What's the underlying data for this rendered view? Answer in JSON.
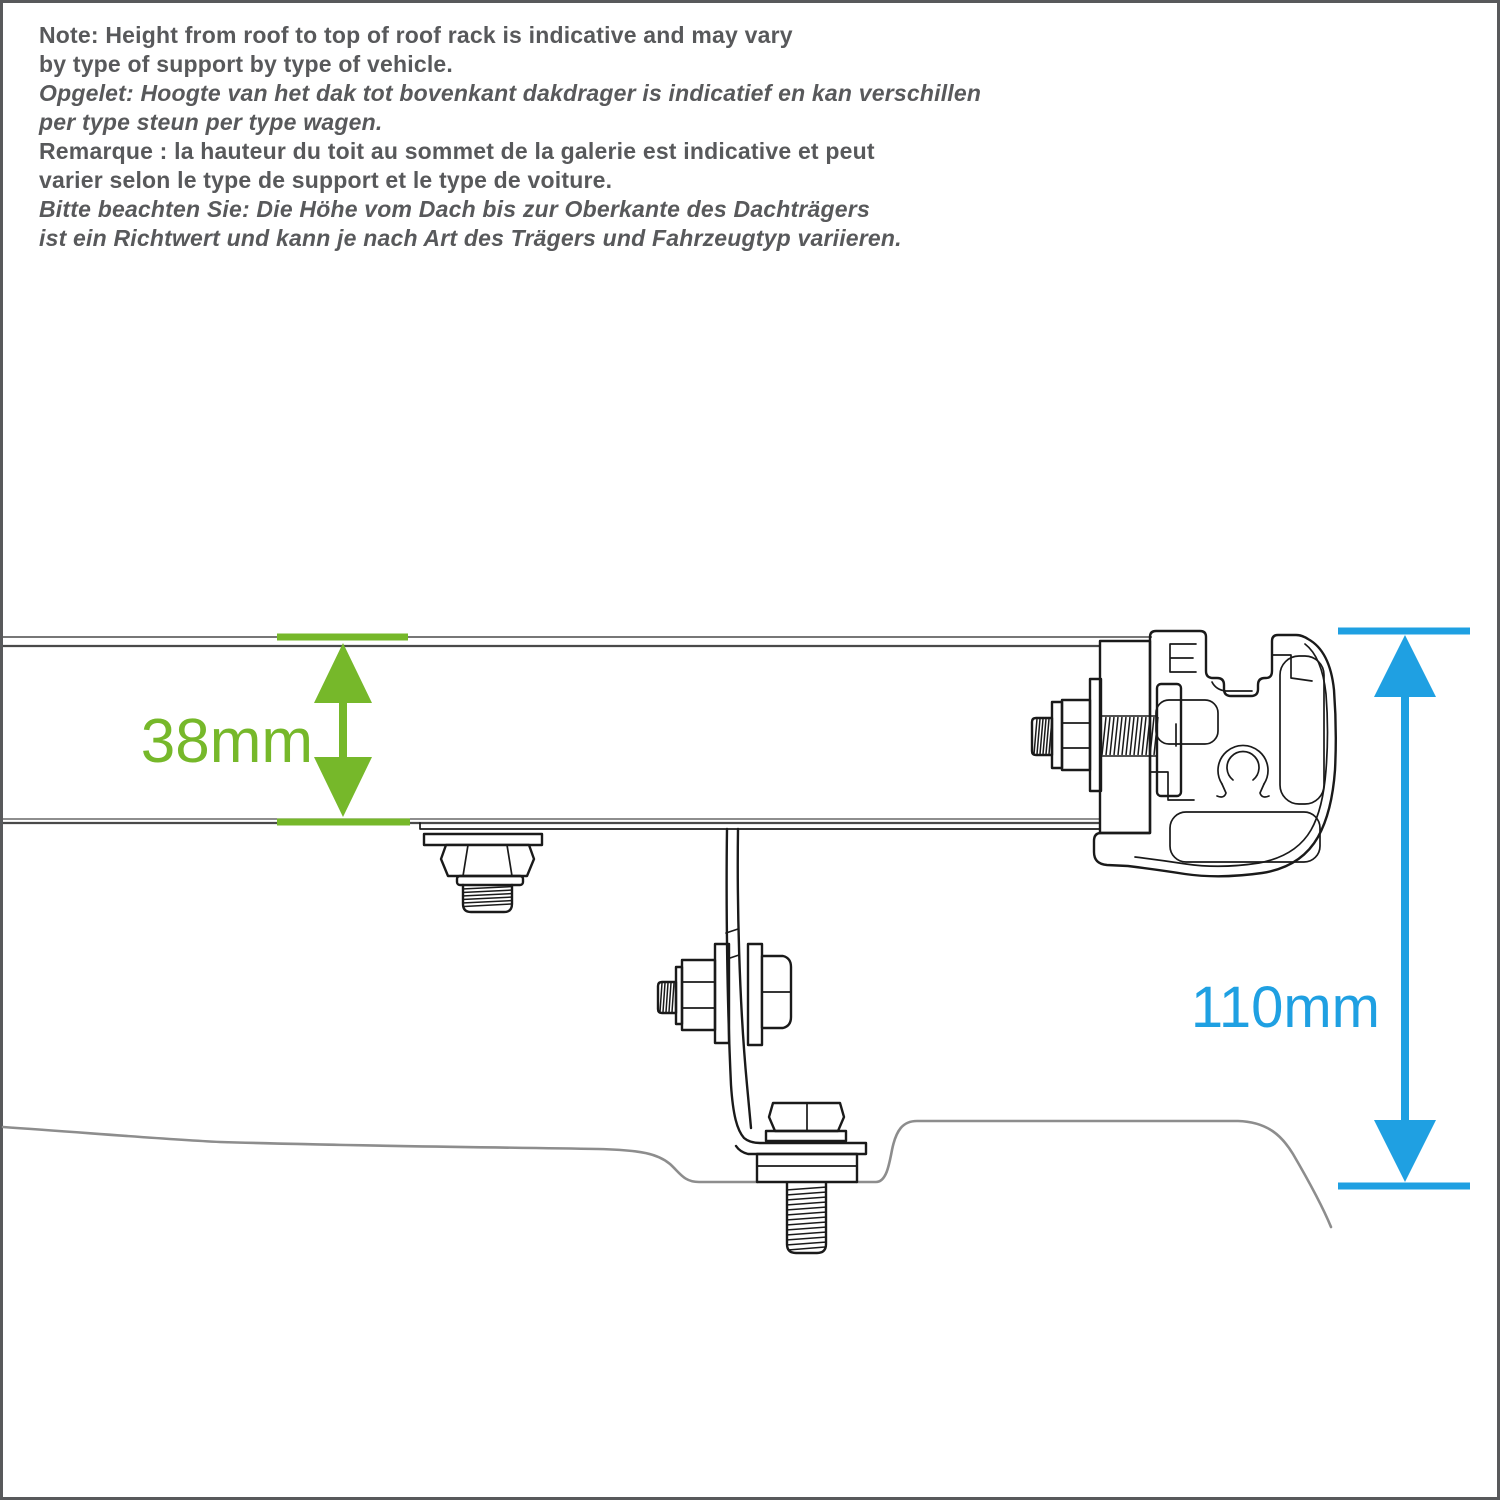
{
  "colors": {
    "accent_green": "#76B82A",
    "accent_blue": "#1FA0E2",
    "text_gray": "#58595B",
    "frame_gray": "#58595B",
    "drawing_dark": "#4a4a4a",
    "drawing_black": "#1a1a1a",
    "roof_gray": "#8d8d8d"
  },
  "note": {
    "lines": [
      {
        "text": "Note: Height from roof to top of roof rack is indicative and may vary",
        "style": "bold"
      },
      {
        "text": "by type of support by type of vehicle.",
        "style": "bold"
      },
      {
        "text": "Opgelet: Hoogte van het dak tot bovenkant dakdrager is indicatief en kan verschillen",
        "style": "bold-italic"
      },
      {
        "text": "per type steun per type wagen.",
        "style": "bold-italic"
      },
      {
        "text": "Remarque : la hauteur du toit au sommet de la galerie est indicative et peut",
        "style": "bold"
      },
      {
        "text": "varier selon le type de support et le type de voiture.",
        "style": "bold"
      },
      {
        "text": "Bitte beachten Sie: Die Höhe vom Dach bis zur Oberkante des Dachträgers",
        "style": "bold-italic"
      },
      {
        "text": "ist ein Richtwert und kann je nach Art des Trägers und Fahrzeugtyp variieren.",
        "style": "bold-italic"
      }
    ]
  },
  "dimensions": {
    "rack_height": {
      "label": "38mm"
    },
    "total_height": {
      "label": "110mm"
    }
  }
}
